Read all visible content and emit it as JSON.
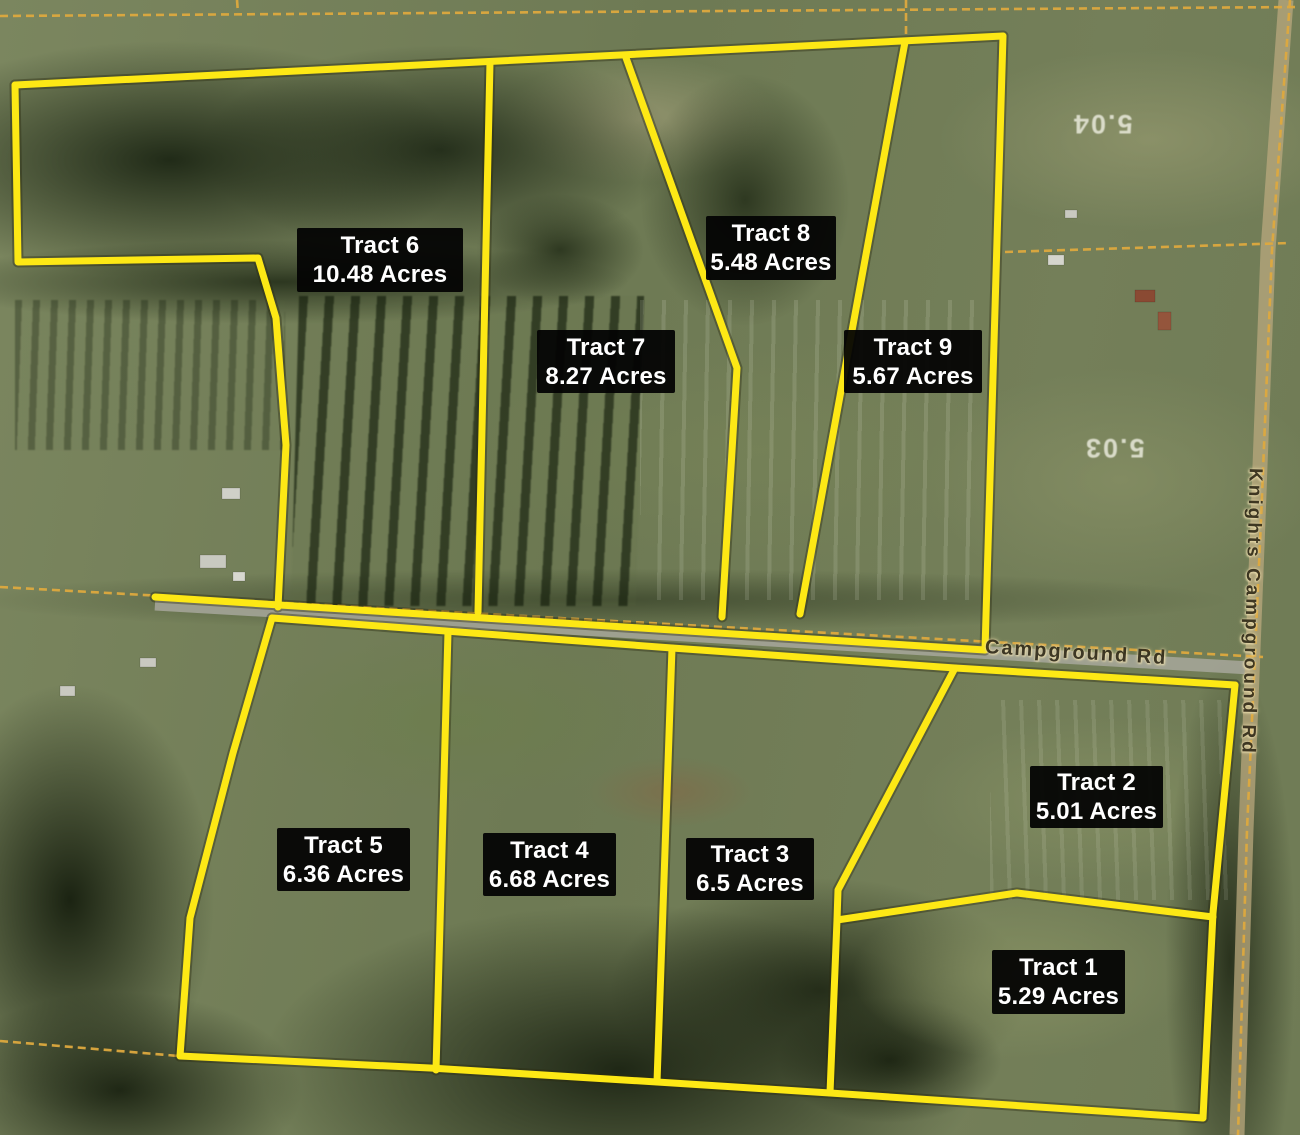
{
  "tracts": [
    {
      "name": "Tract 1",
      "acres": "5.29 Acres"
    },
    {
      "name": "Tract 2",
      "acres": "5.01 Acres"
    },
    {
      "name": "Tract 3",
      "acres": "6.5 Acres"
    },
    {
      "name": "Tract 4",
      "acres": "6.68 Acres"
    },
    {
      "name": "Tract 5",
      "acres": "6.36 Acres"
    },
    {
      "name": "Tract 6",
      "acres": "10.48 Acres"
    },
    {
      "name": "Tract 7",
      "acres": "8.27 Acres"
    },
    {
      "name": "Tract 8",
      "acres": "5.48 Acres"
    },
    {
      "name": "Tract 9",
      "acres": "5.67 Acres"
    }
  ],
  "roads": [
    {
      "name": "Knights Campground Rd",
      "orientation": "vertical"
    },
    {
      "name": "Campground Rd",
      "orientation": "horizontal"
    }
  ],
  "parcel_numbers": [
    {
      "value": "5.04"
    },
    {
      "value": "5.03"
    }
  ],
  "colors": {
    "tract_boundary": "#fde815",
    "parcel_line": "#dda93e",
    "label_background": "#000000",
    "label_text": "#ffffff"
  }
}
